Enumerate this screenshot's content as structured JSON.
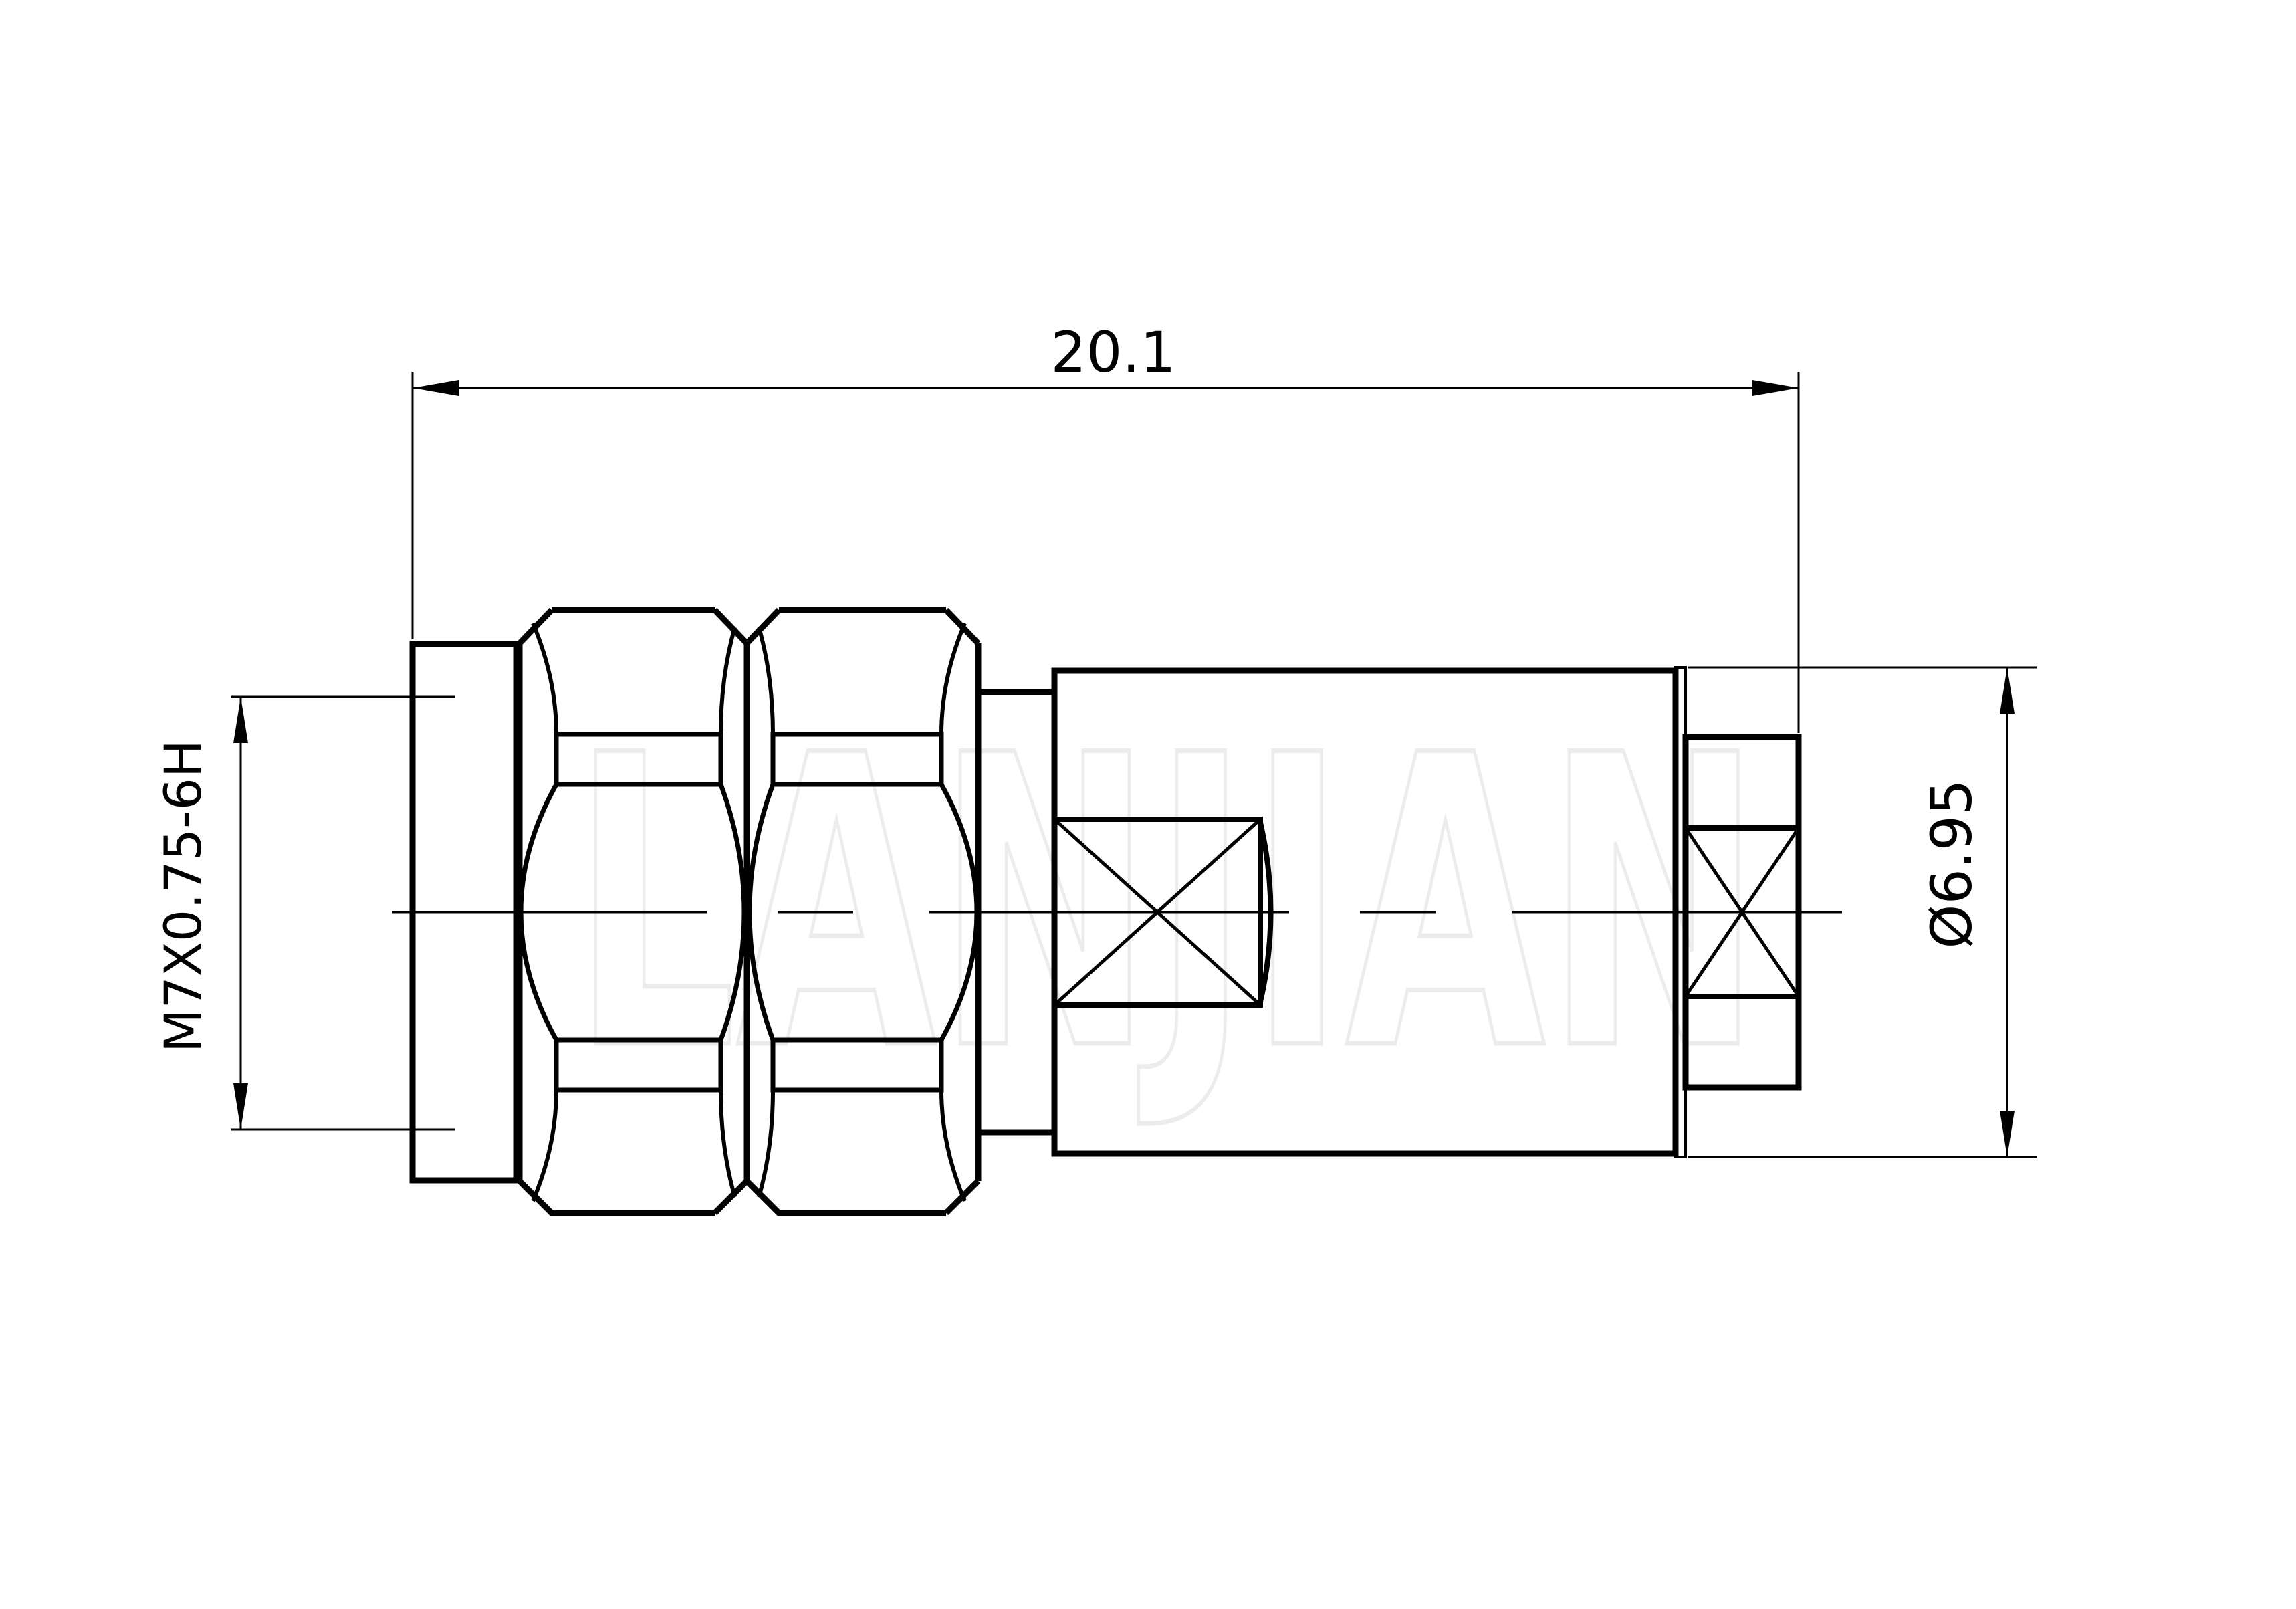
{
  "drawing": {
    "type": "technical-drawing",
    "view": "connector side elevation",
    "dimensions": {
      "overall_length": {
        "label": "20.1",
        "value": 20.1
      },
      "thread_spec": {
        "label": "M7X0.75-6H"
      },
      "rear_diameter": {
        "label": "Ø6.95",
        "value": 6.95
      }
    },
    "watermark": {
      "text": "LANJIAN"
    },
    "colors": {
      "line": "#000000",
      "background": "#ffffff",
      "watermark_stroke": "#ececec"
    }
  }
}
